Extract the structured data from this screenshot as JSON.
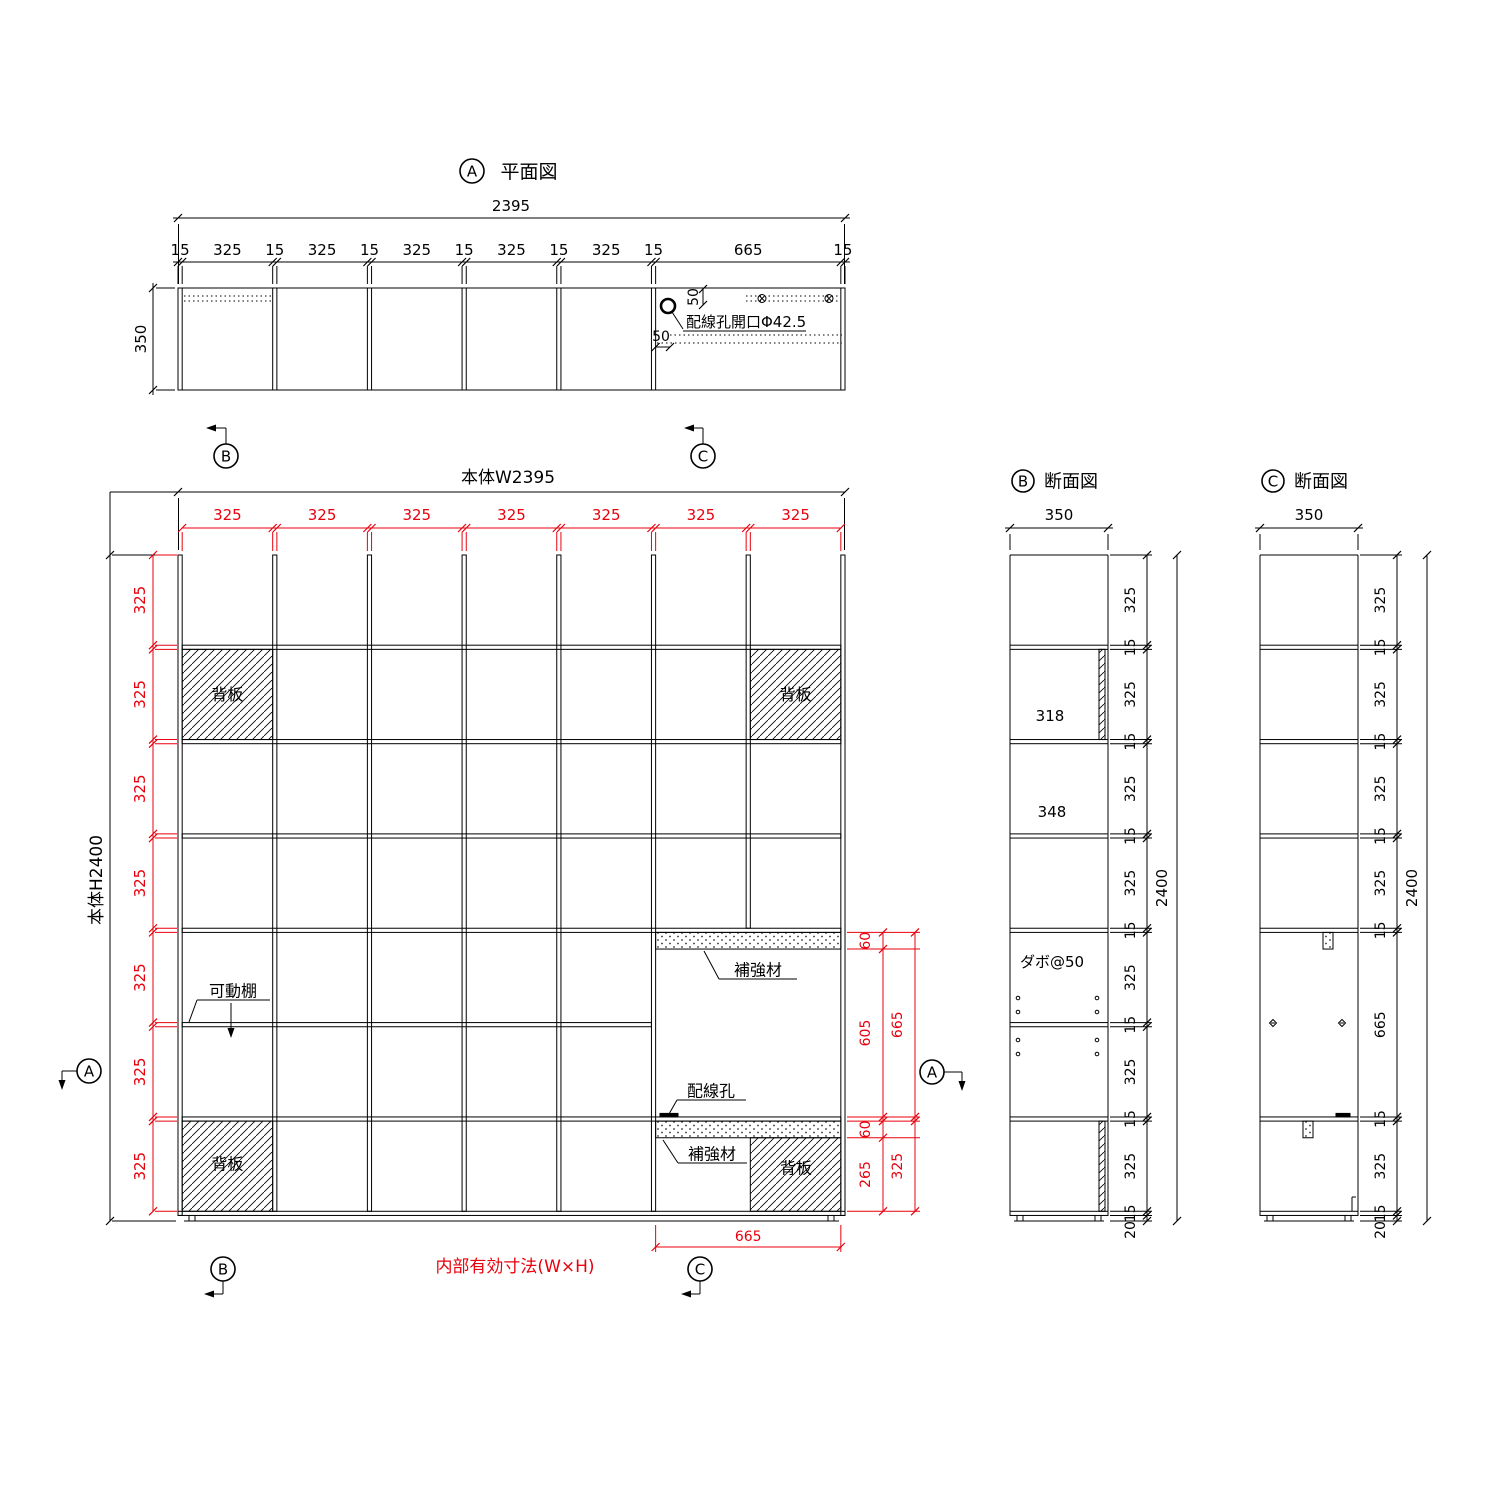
{
  "colors": {
    "line": "#000000",
    "dim": "#e8000d",
    "bg": "#ffffff"
  },
  "plan": {
    "marker": "A",
    "title": "平面図",
    "overall_width": "2395",
    "depth": "350",
    "subdims": [
      "15",
      "325",
      "15",
      "325",
      "15",
      "325",
      "15",
      "325",
      "15",
      "325",
      "15",
      "665",
      "15"
    ],
    "wiring_hole_label": "配線孔開口Φ42.5",
    "hole_offset_v": "50",
    "hole_offset_h": "50"
  },
  "elevation": {
    "width_label": "本体W2395",
    "height_label": "本体H2400",
    "top_dims": [
      "325",
      "325",
      "325",
      "325",
      "325",
      "325",
      "325"
    ],
    "left_dims": [
      "325",
      "325",
      "325",
      "325",
      "325",
      "325",
      "325"
    ],
    "right_dims": {
      "reinf_top": "60",
      "clear": "605",
      "opening": "665",
      "reinf_bottom": "60",
      "back_panel": "265",
      "bottom_cell": "325"
    },
    "bottom_width": "665",
    "back_panel": "背板",
    "movable_shelf": "可動棚",
    "reinforcement": "補強材",
    "wiring_hole": "配線孔",
    "internal_note": "内部有効寸法(W×H)"
  },
  "section_b": {
    "marker": "B",
    "title": "断面図",
    "depth": "350",
    "overall_height": "2400",
    "base_height": "20",
    "depth_with_back": "318",
    "depth_open": "348",
    "dowel_pitch": "ダボ@50",
    "dims": [
      "325",
      "15",
      "325",
      "15",
      "325",
      "15",
      "325",
      "15",
      "325",
      "15",
      "325",
      "15",
      "325",
      "15"
    ]
  },
  "section_c": {
    "marker": "C",
    "title": "断面図",
    "depth": "350",
    "overall_height": "2400",
    "base_height": "20",
    "dims": [
      "325",
      "15",
      "325",
      "15",
      "325",
      "15",
      "325",
      "15",
      "665",
      "15",
      "325",
      "15"
    ]
  },
  "markers": {
    "a": "A",
    "b": "B",
    "c": "C"
  }
}
